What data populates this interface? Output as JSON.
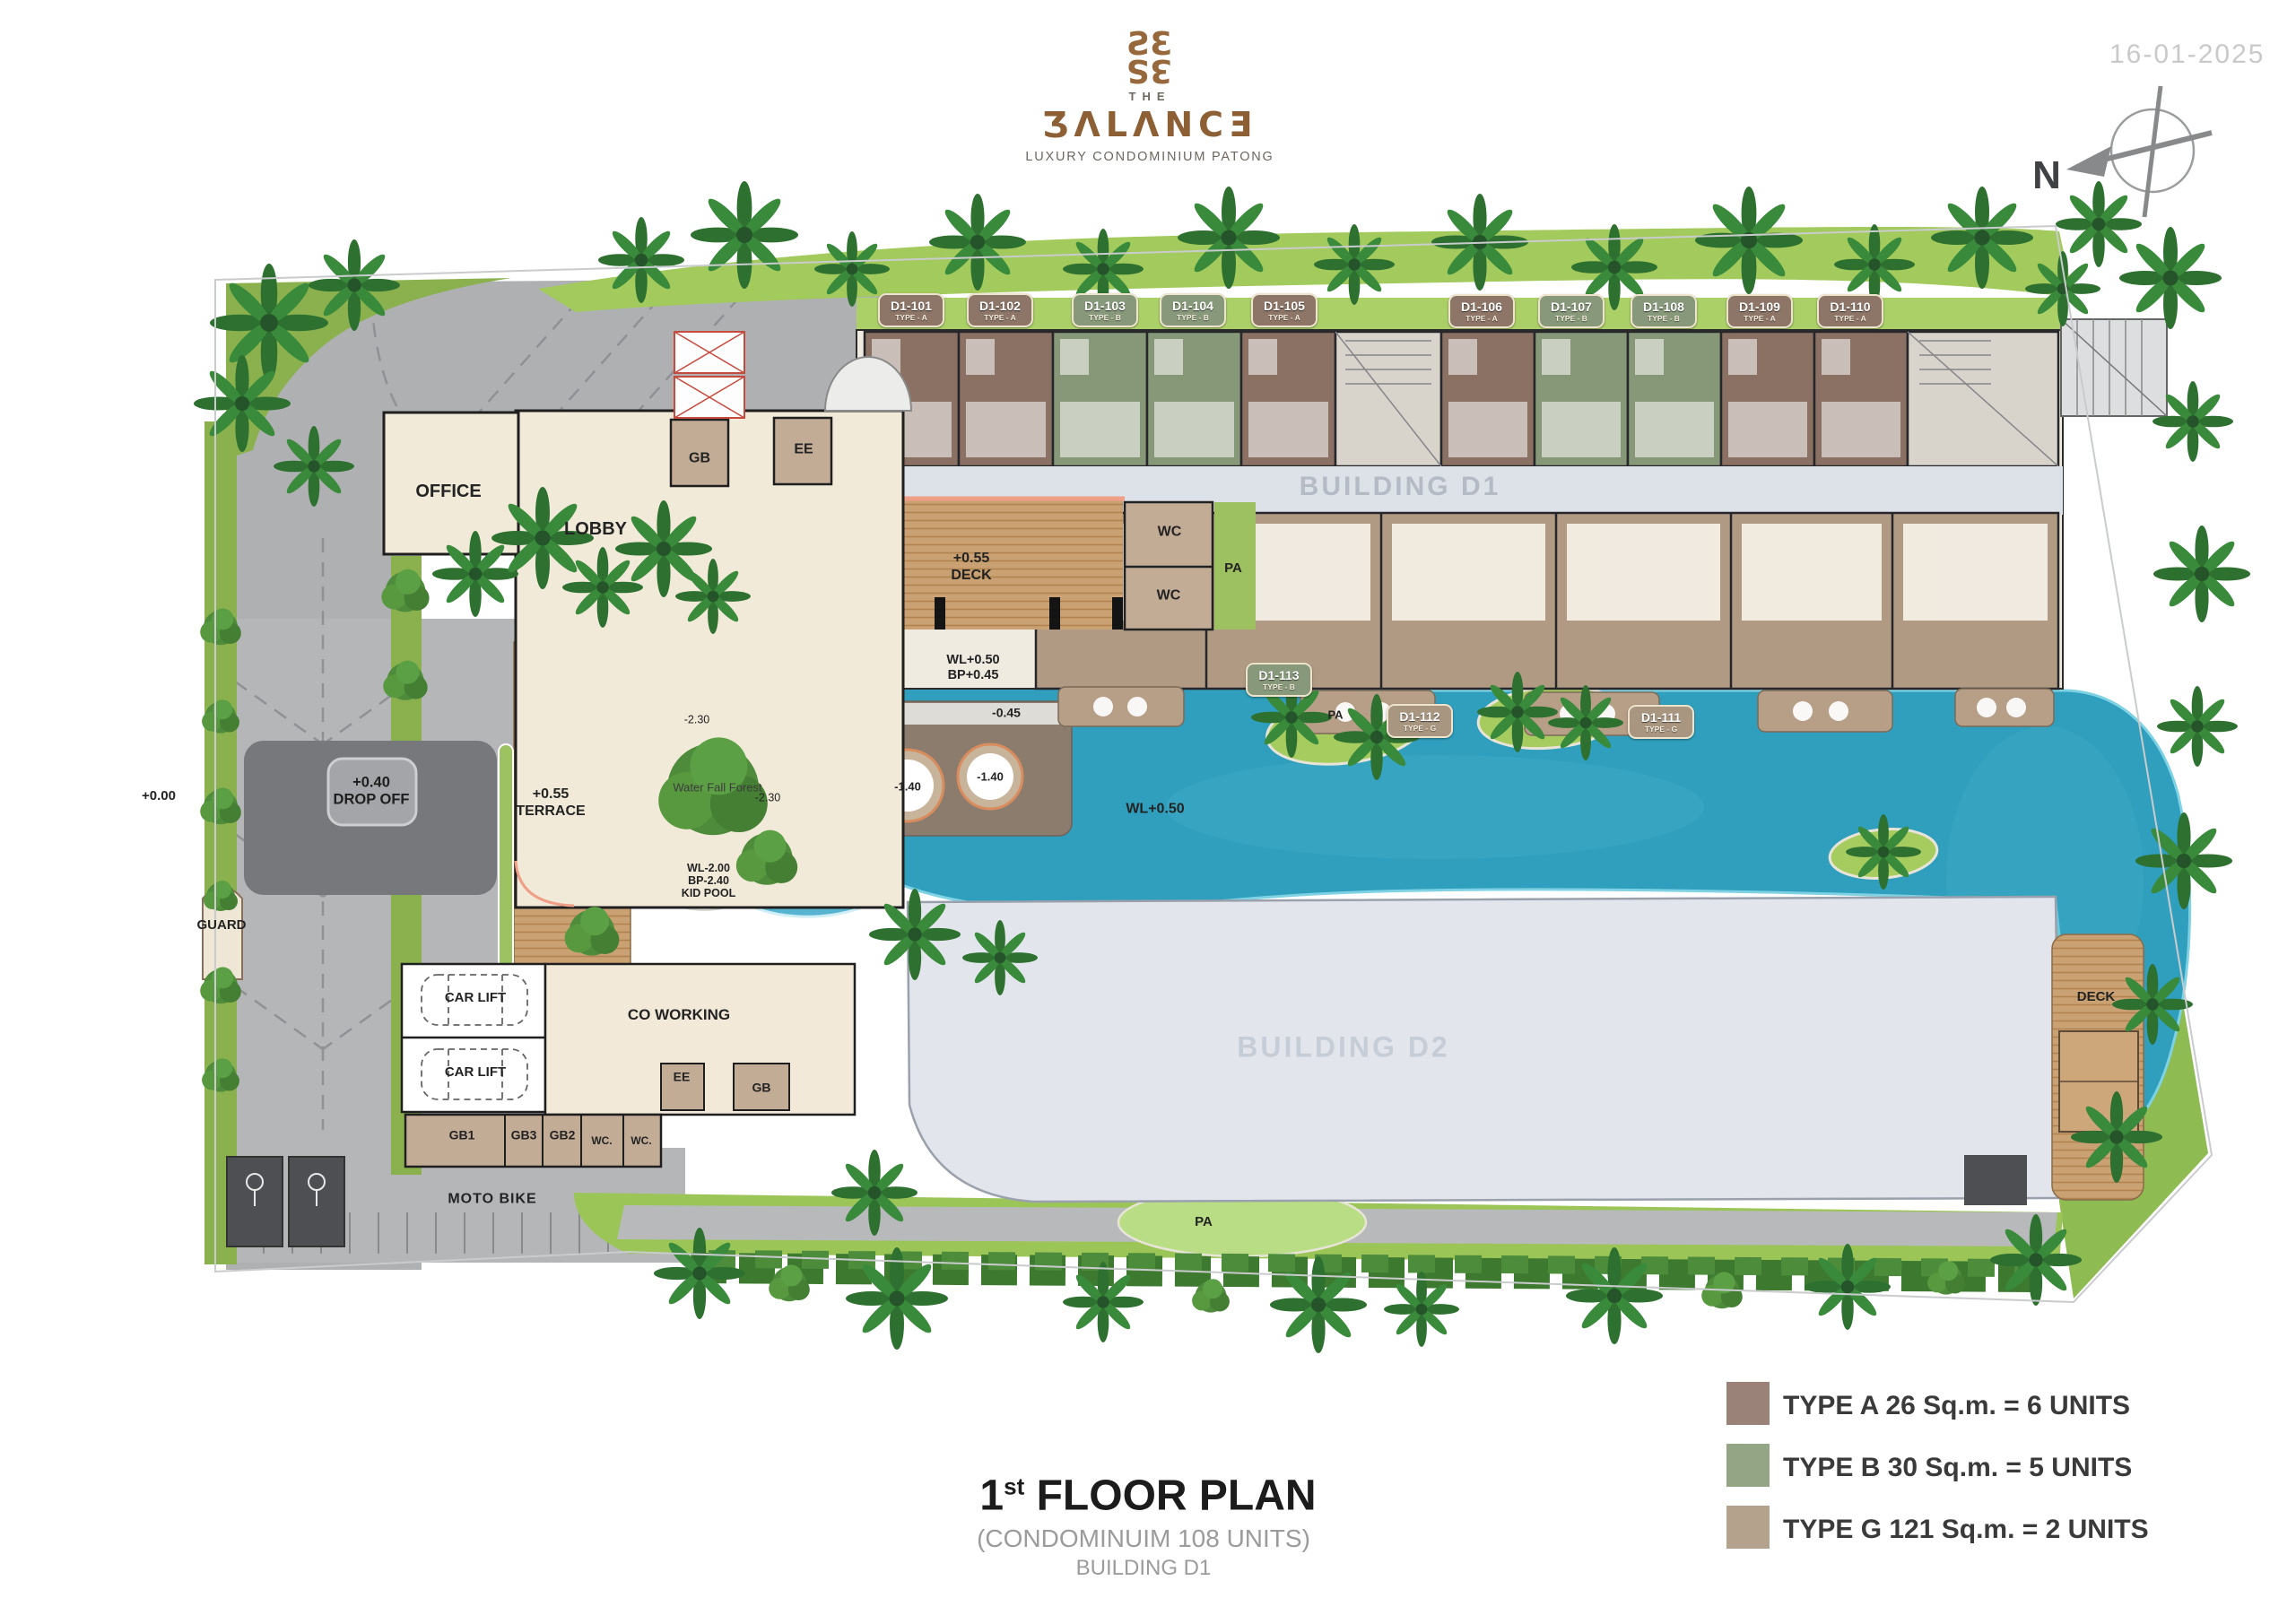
{
  "header": {
    "date": "16-01-2025",
    "compass_n": "N",
    "logo": {
      "monogram": "ƧƐ",
      "the": "THE",
      "name_display": "ƷΛLΛNCƎ",
      "tagline": "LUXURY CONDOMINIUM PATONG"
    }
  },
  "buildings": {
    "d1": "BUILDING D1",
    "d2": "BUILDING D2"
  },
  "units": [
    {
      "id": "D1-101",
      "type": "TYPE - A"
    },
    {
      "id": "D1-102",
      "type": "TYPE - A"
    },
    {
      "id": "D1-103",
      "type": "TYPE - B"
    },
    {
      "id": "D1-104",
      "type": "TYPE - B"
    },
    {
      "id": "D1-105",
      "type": "TYPE - A"
    },
    {
      "id": "D1-106",
      "type": "TYPE - A"
    },
    {
      "id": "D1-107",
      "type": "TYPE - B"
    },
    {
      "id": "D1-108",
      "type": "TYPE - B"
    },
    {
      "id": "D1-109",
      "type": "TYPE - A"
    },
    {
      "id": "D1-110",
      "type": "TYPE - A"
    },
    {
      "id": "D1-113",
      "type": "TYPE - B"
    },
    {
      "id": "D1-112",
      "type": "TYPE - G"
    },
    {
      "id": "D1-111",
      "type": "TYPE - G"
    }
  ],
  "labels": {
    "office": "OFFICE",
    "lobby": "LOBBY",
    "gb_top": "GB",
    "ee_top": "EE",
    "wc_top": "WC",
    "wc_mid": "WC",
    "pa_deck": "PA",
    "deck_level": "+0.55",
    "deck_name": "DECK",
    "wl_upper": "WL+0.50",
    "bp_upper": "BP+0.45",
    "road_level": "+0.00",
    "dropoff_level": "+0.40",
    "dropoff_name": "DROP OFF",
    "guard": "GUARD",
    "terrace_level": "+0.55",
    "terrace_name": "TERRACE",
    "depth_230_a": "-2.30",
    "waterfall": "Water Fall Forest",
    "depth_230_b": "-2.30",
    "depth_045": "-0.45",
    "spa_a": "-1.40",
    "spa_b": "-1.40",
    "kid_wl": "WL-2.00",
    "kid_bp": "BP-2.40",
    "kid_name": "KID POOL",
    "pool_wl": "WL+0.50",
    "car_lift_1": "CAR LIFT",
    "car_lift_2": "CAR LIFT",
    "coworking": "CO WORKING",
    "ee_lower": "EE",
    "gb_lower": "GB",
    "gb1": "GB1",
    "gb3": "GB3",
    "gb2": "GB2",
    "wc_low_1": "WC.",
    "wc_low_2": "WC.",
    "moto": "MOTO BIKE",
    "pa_island": "PA",
    "pa_lawn": "PA",
    "deck_right": "DECK"
  },
  "footer": {
    "title_number": "1",
    "title_ordinal": "st",
    "title_text": " FLOOR PLAN",
    "subtitle": "(CONDOMINUIM 108 UNITS)",
    "building": "BUILDING D1"
  },
  "legend": [
    {
      "label": "TYPE A 26 Sq.m. = 6 UNITS",
      "color": "#9b8278"
    },
    {
      "label": "TYPE B 30 Sq.m. = 5 UNITS",
      "color": "#93a585"
    },
    {
      "label": "TYPE G 121 Sq.m. = 2 UNITS",
      "color": "#b5a28c"
    }
  ],
  "colors": {
    "pool": "#2f9fbd",
    "type_a_fill": "#8d7568",
    "type_b_fill": "#87997a",
    "type_g_fill": "#a99681",
    "logo_bronze": "#8d5f35",
    "date_gray": "#c9c9c9"
  }
}
